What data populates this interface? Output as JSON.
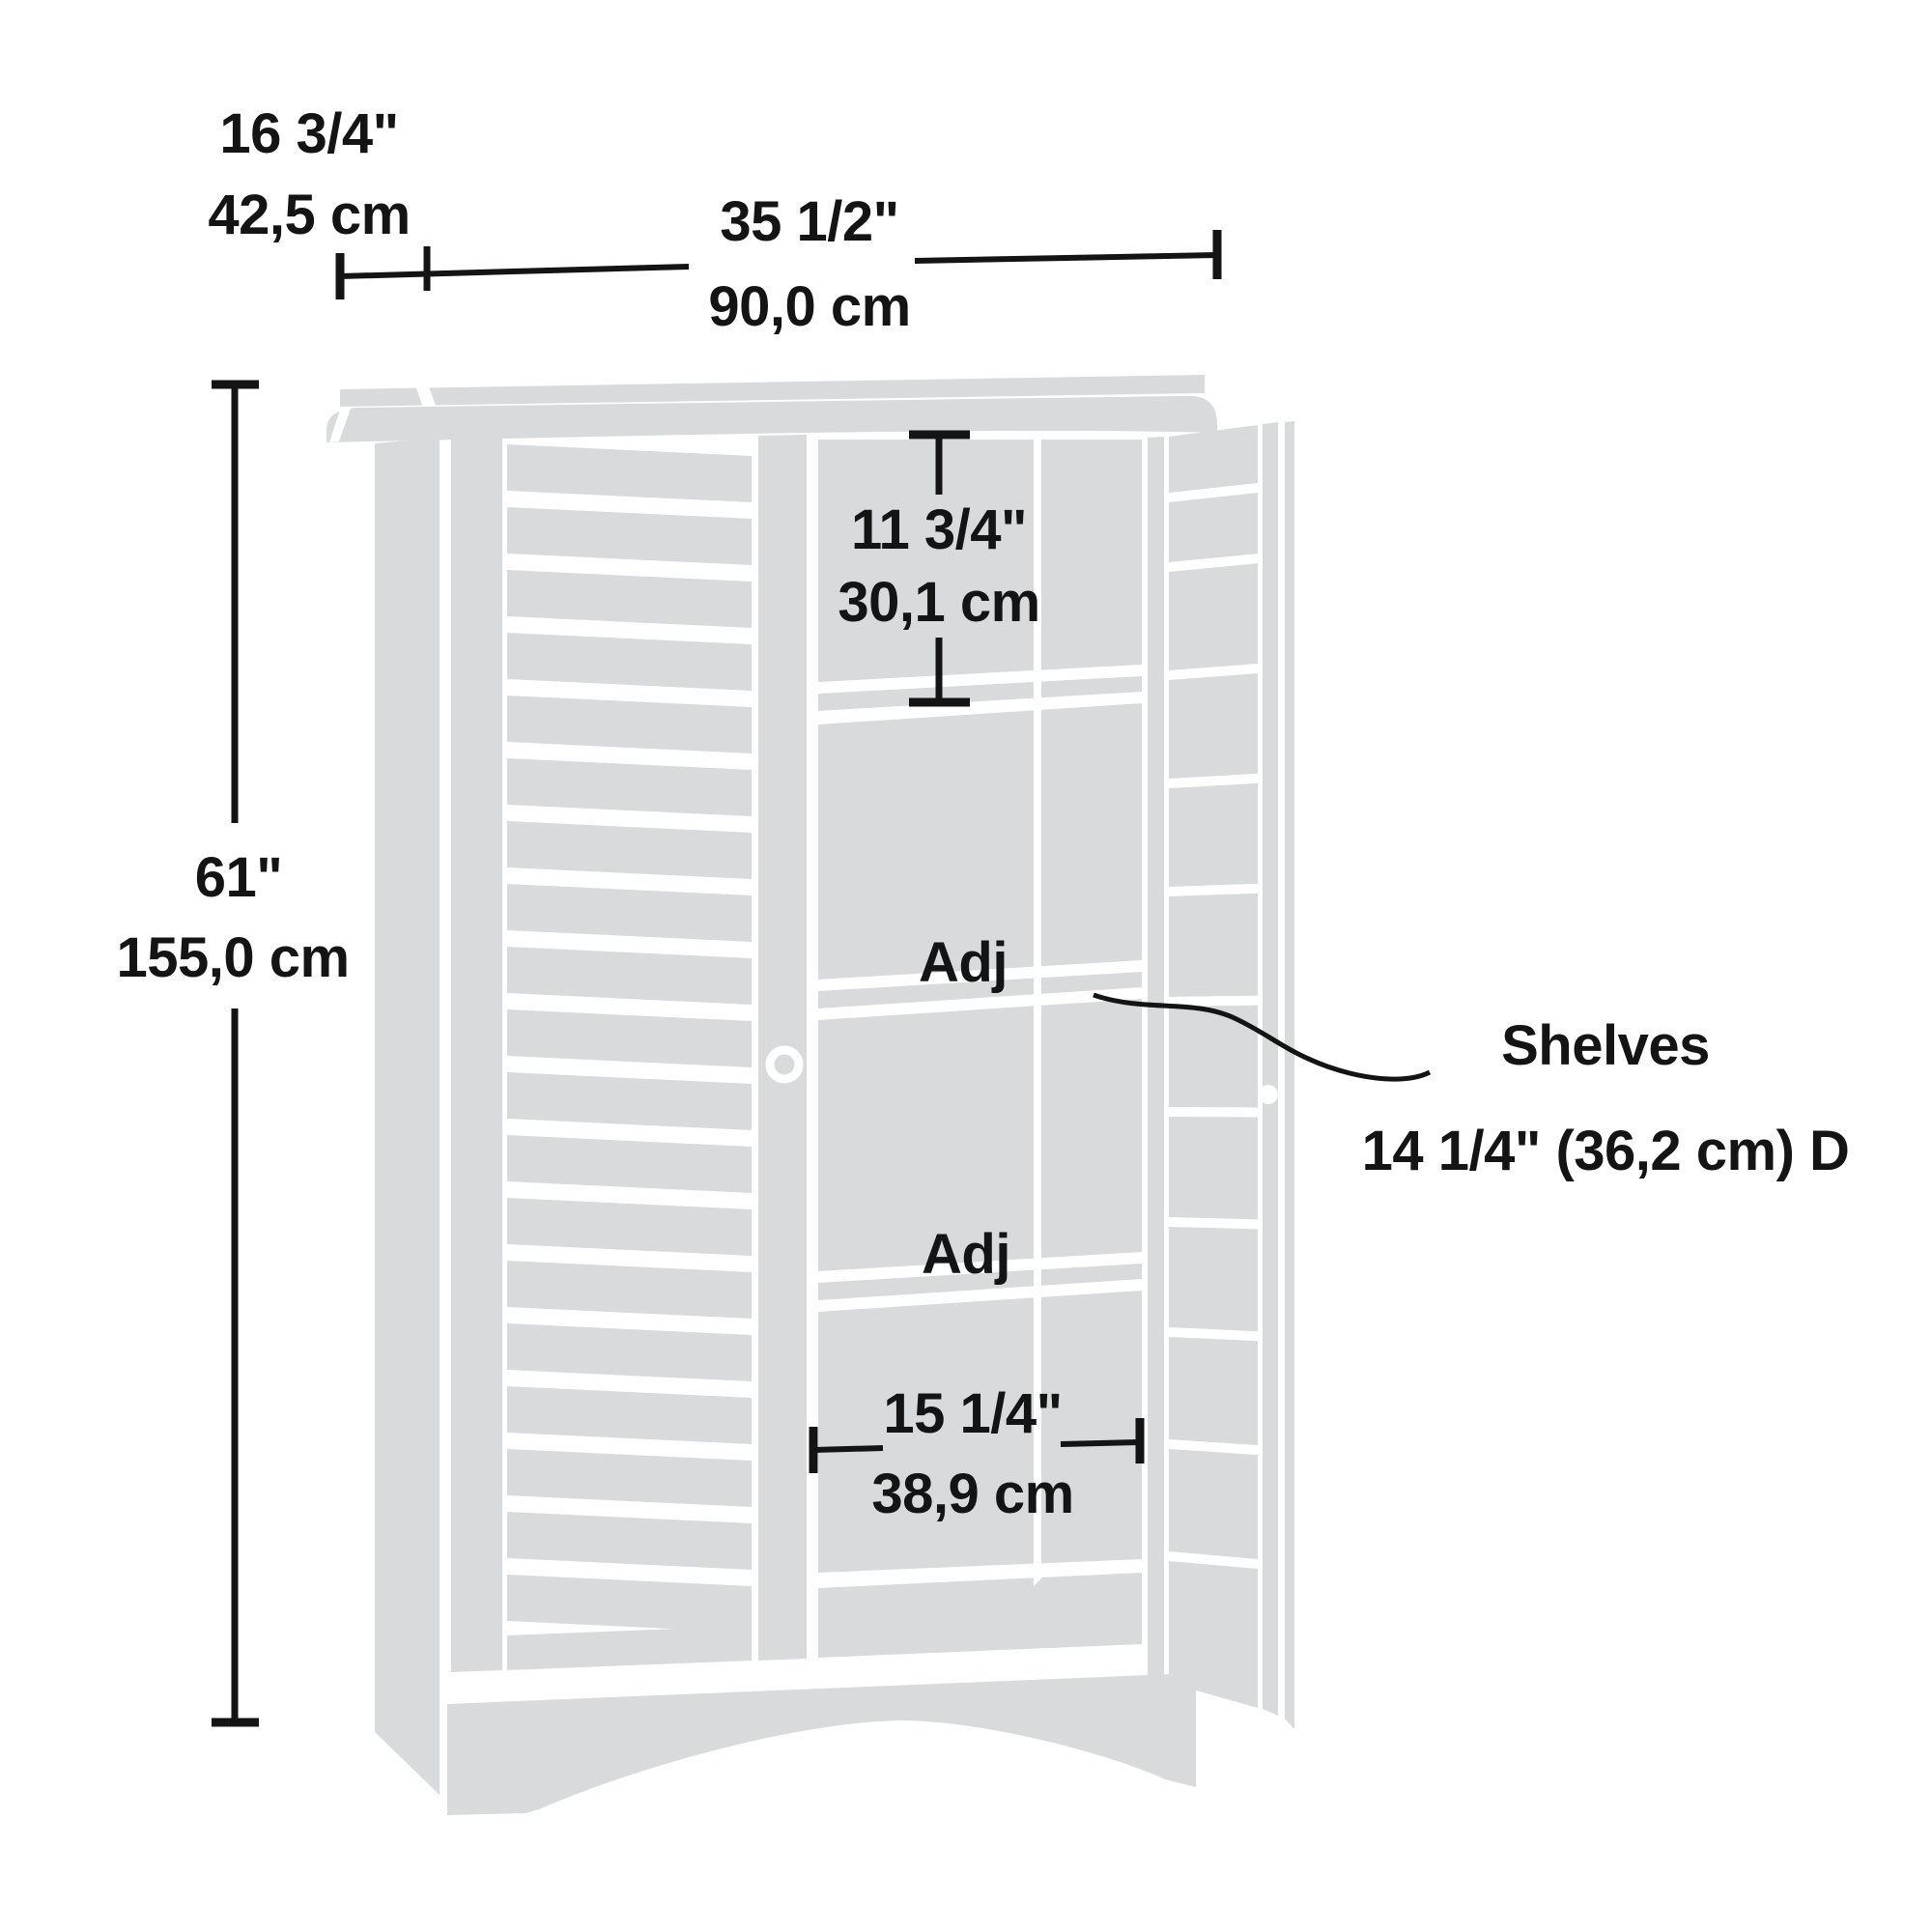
{
  "diagram": {
    "type": "furniture-dimension-drawing",
    "subject": "two-door storage cabinet with louvered doors, right door open showing shelves",
    "colors": {
      "line": "#141414",
      "cabinet_fill": "#d9dadb",
      "background": "#ffffff"
    },
    "labels": {
      "depth_in": "16 3/4\"",
      "depth_cm": "42,5 cm",
      "width_in": "35 1/2\"",
      "width_cm": "90,0 cm",
      "height_in": "61\"",
      "height_cm": "155,0 cm",
      "top_opening_in": "11 3/4\"",
      "top_opening_cm": "30,1 cm",
      "adj_shelf_1": "Adj",
      "adj_shelf_2": "Adj",
      "bottom_opening_in": "15 1/4\"",
      "bottom_opening_cm": "38,9 cm",
      "shelves_note_title": "Shelves",
      "shelves_note_detail": "14 1/4\" (36,2 cm) D"
    }
  }
}
